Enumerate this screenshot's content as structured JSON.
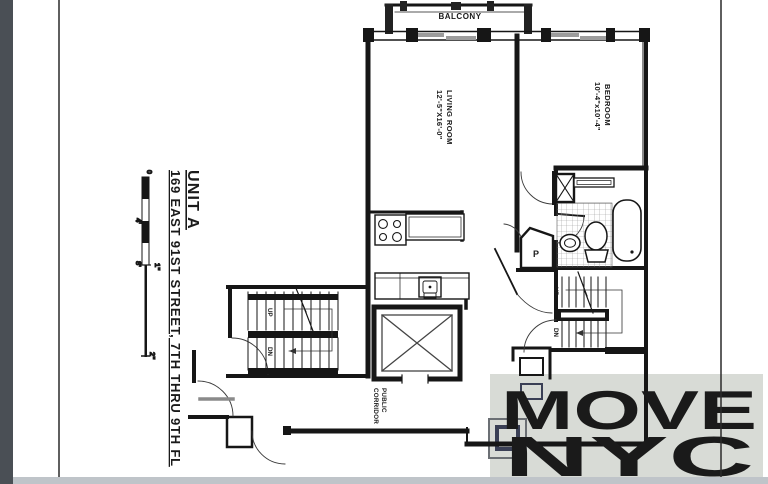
{
  "page": {
    "bg": "#ffffff",
    "side_strip_color": "#4a4f55",
    "rule_color": "#2a2a2a",
    "bottom_strip_color": "#bfc4c9"
  },
  "title_block": {
    "unit": "UNIT A",
    "address": "169 EAST 91ST STREET, 7TH THRU 9TH FL"
  },
  "scale_bar": {
    "tick_zero": "0",
    "tick_4ft": "4'",
    "tick_8ft": "8'",
    "tick_1in": "1\"",
    "tick_2in": "2\""
  },
  "plan": {
    "balcony_label": "BALCONY",
    "living_room": {
      "label": "LIVING ROOM",
      "dims": "12'-5\"X16'-0\""
    },
    "bedroom": {
      "label": "BEDROOM",
      "dims": "10'-4\"x10'-4\""
    },
    "closet_label": "P",
    "corridor": {
      "line1": "PUBLIC",
      "line2": "CORRIDOR"
    },
    "stair_left": {
      "up": "UP",
      "down": "DN"
    },
    "stair_right": {
      "up": "UP",
      "down": "DN"
    }
  },
  "logo": {
    "line1": "MOVE",
    "line2": "NYC",
    "panel_color": "#d8dbd6",
    "sky_color": "#8a6592",
    "night_color": "#393453",
    "lights_color": "#c0763d"
  }
}
